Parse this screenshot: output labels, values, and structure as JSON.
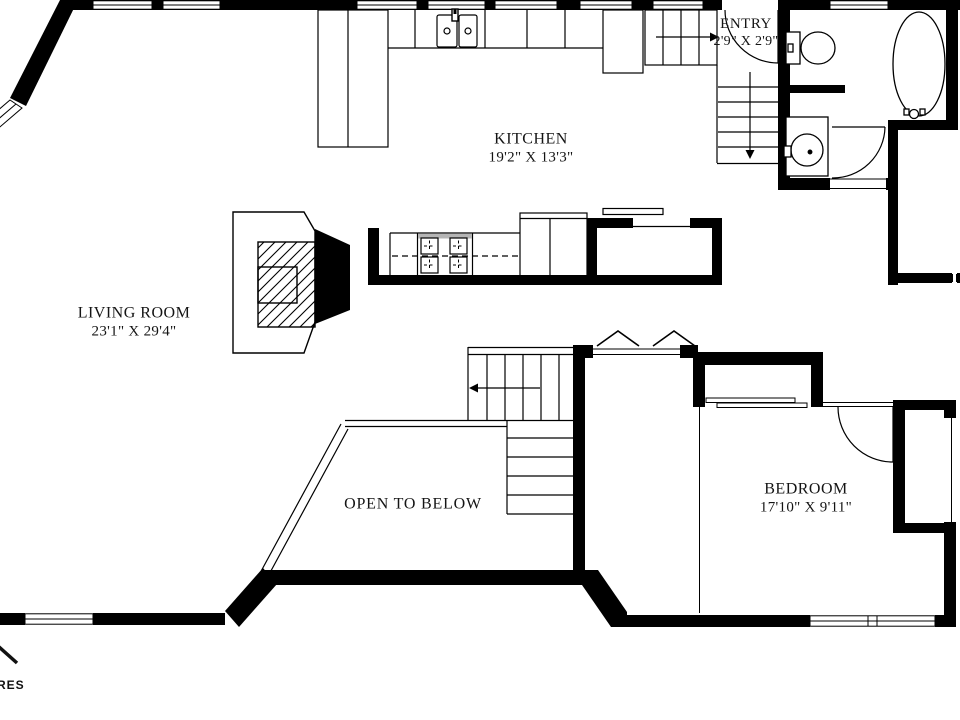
{
  "plan": {
    "title": "Floor plan",
    "rooms": {
      "living_room": {
        "name": "LIVING ROOM",
        "dims": "23'1\" X 29'4\""
      },
      "kitchen": {
        "name": "KITCHEN",
        "dims": "19'2\" X 13'3\""
      },
      "entry": {
        "name": "ENTRY",
        "dims": "2'9\" X 2'9\""
      },
      "open_to_below": {
        "name": "OPEN TO BELOW"
      },
      "bedroom": {
        "name": "BEDROOM",
        "dims": "17'10\" X 9'11\""
      }
    },
    "fixtures": [
      "fireplace",
      "cooktop",
      "kitchen-sink",
      "refrigerator",
      "kitchen-island",
      "pantry-closet",
      "entry-stairs",
      "stairs",
      "toilet",
      "vanity-sink",
      "bathtub",
      "bedroom-closet",
      "sliding-doors",
      "door-swings",
      "windows",
      "open-to-below-railing"
    ],
    "colors": {
      "wall": "#000000",
      "background": "#ffffff",
      "cooktop_strip": "#b5b5b5",
      "text": "#141414"
    },
    "watermark": {
      "text": "RES"
    }
  }
}
